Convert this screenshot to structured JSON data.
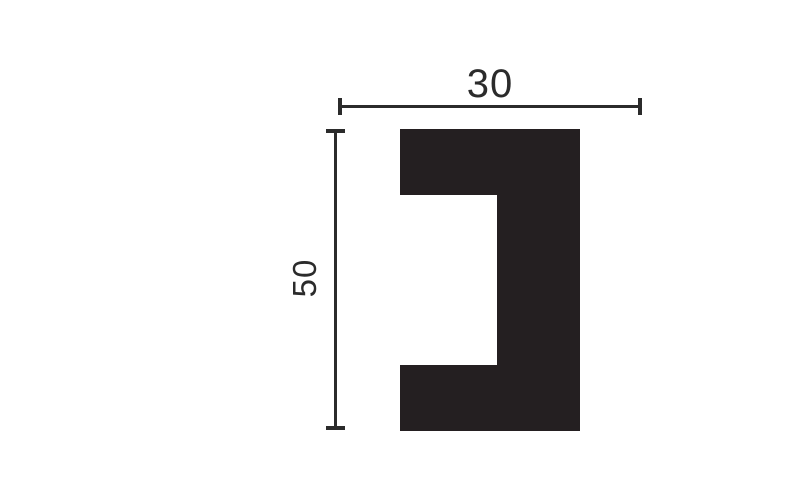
{
  "diagram": {
    "width_label": "30",
    "height_label": "50",
    "colors": {
      "shape": "#241f21",
      "line": "#2b2b2b",
      "text": "#2b2b2b",
      "background": "#ffffff"
    }
  }
}
